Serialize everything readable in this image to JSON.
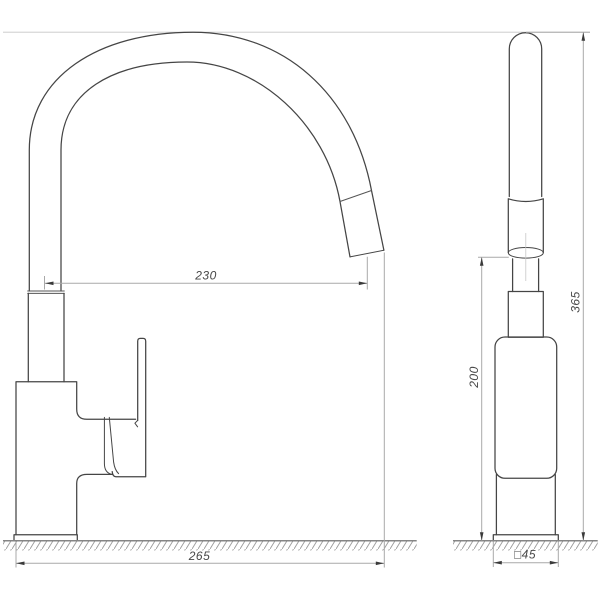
{
  "diagram": {
    "kind": "technical-drawing",
    "views": {
      "side": {
        "dimensions": {
          "spout_reach": {
            "value": "230"
          },
          "overall_depth": {
            "value": "265"
          }
        }
      },
      "front": {
        "dimensions": {
          "spout_height": {
            "value": "200"
          },
          "overall_height": {
            "value": "365"
          },
          "base_square": {
            "value": "□45"
          }
        }
      }
    },
    "colors": {
      "background": "#ffffff",
      "outline": "#454545",
      "seam": "#555555",
      "dimension": "#a9a9a9",
      "construction": "#c6c6c6",
      "arrow": "#3a3a3a",
      "text": "#474747",
      "ground": "#858585",
      "hatch": "#9b9b9b"
    }
  }
}
